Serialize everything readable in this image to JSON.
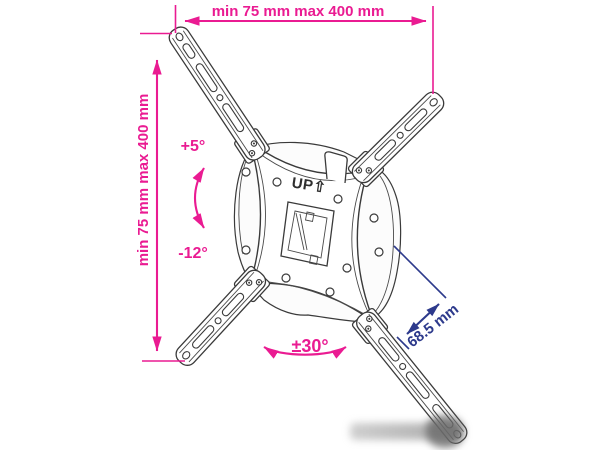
{
  "colors": {
    "dimension_pink": "#EA1B92",
    "dimension_blue": "#2D3A8C",
    "drawing_line": "#3A3A3A",
    "background": "#FFFFFF"
  },
  "annotations": {
    "top_width": "min 75 mm max 400 mm",
    "left_height": "min 75 mm max 400 mm",
    "tilt_up_angle": "+5°",
    "tilt_down_angle": "-12°",
    "swivel_angle": "±30°",
    "depth": "68.5 mm"
  },
  "bracket": {
    "up_marking": "UP⇧"
  }
}
